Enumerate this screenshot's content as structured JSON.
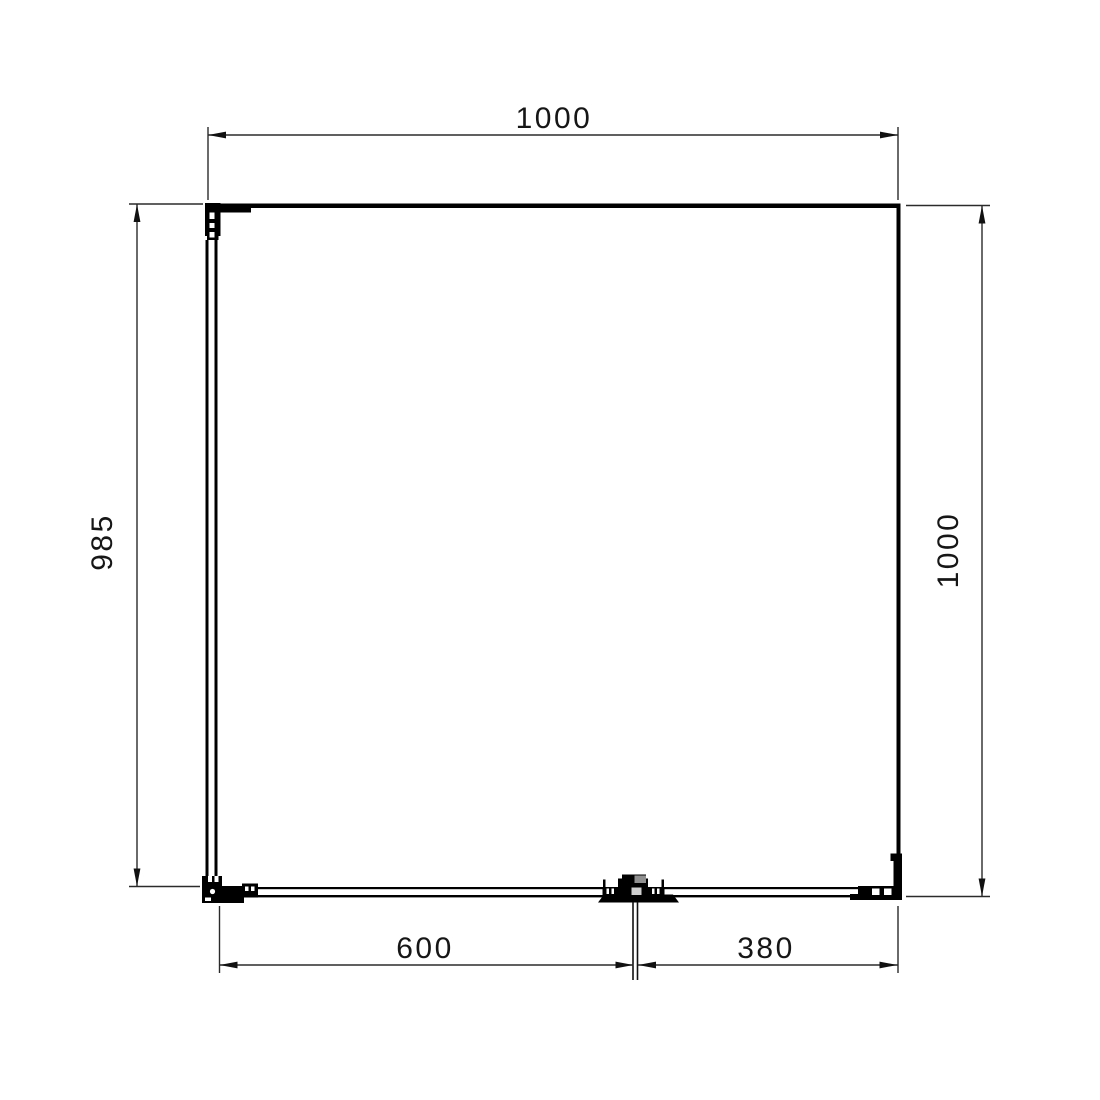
{
  "drawing": {
    "type": "technical-dimension-drawing",
    "background_color": "#ffffff",
    "outline_color": "#000000",
    "dimension_line_color": "#2b2b2b",
    "text_color": "#161616",
    "dimensions": {
      "top_width": {
        "label": "1000",
        "orientation": "horizontal"
      },
      "left_height": {
        "label": "985",
        "orientation": "vertical"
      },
      "right_height": {
        "label": "1000",
        "orientation": "vertical"
      },
      "bottom_left_segment": {
        "label": "600",
        "orientation": "horizontal"
      },
      "bottom_right_segment": {
        "label": "380",
        "orientation": "horizontal"
      }
    }
  }
}
